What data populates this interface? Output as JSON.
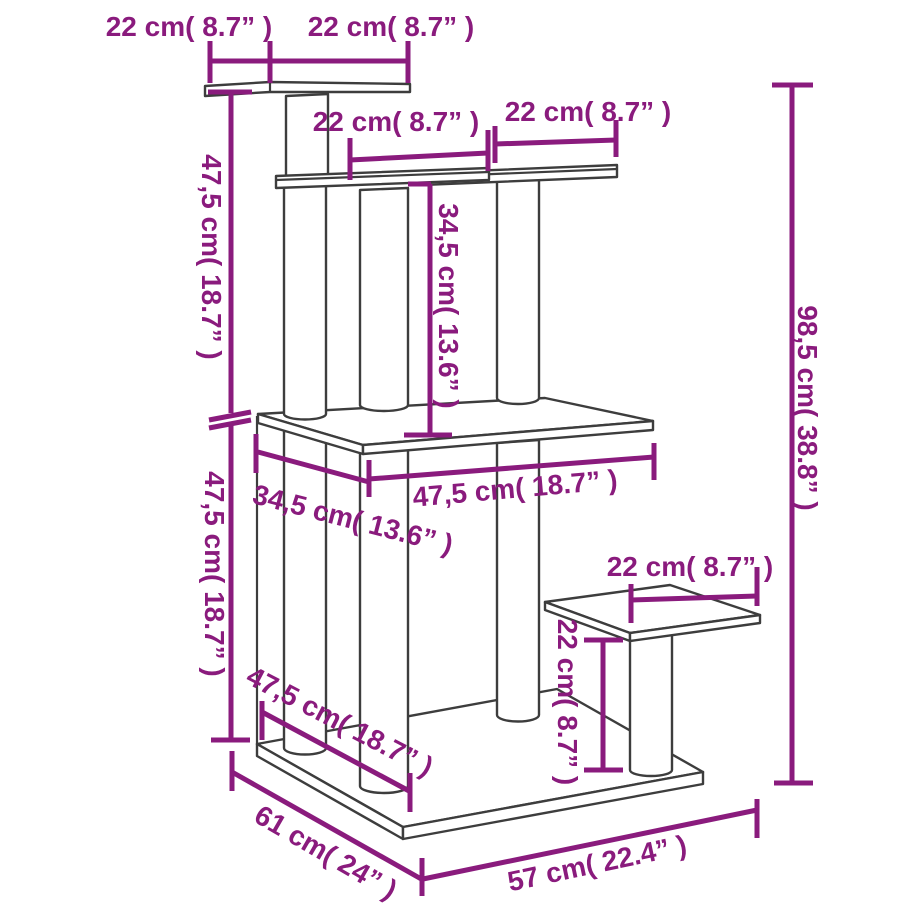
{
  "colors": {
    "dimension": "#8a1b7d",
    "line_art": "#3d3d3d",
    "background": "#ffffff"
  },
  "dimensions": {
    "top_platform_depth": "22 cm( 8.7” )",
    "top_platform_width": "22 cm( 8.7” )",
    "level2_left_platform_width": "22 cm( 8.7” )",
    "level2_right_platform_width": "22 cm( 8.7” )",
    "height_top_to_middle": "47,5 cm( 18.7” )",
    "height_level2_to_middle": "34,5 cm( 13.6” )",
    "total_height": "98,5 cm( 38.8” )",
    "height_middle_to_base": "47,5 cm( 18.7” )",
    "middle_platform_width": "47,5 cm( 18.7” )",
    "middle_platform_depth": "34,5 cm( 13.6” )",
    "base_front_span": "47,5 cm( 18.7” )",
    "base_depth": "61 cm( 24” )",
    "base_width": "57 cm( 22.4” )",
    "step_platform_width": "22 cm( 8.7” )",
    "step_platform_height": "22 cm( 8.7” )"
  }
}
